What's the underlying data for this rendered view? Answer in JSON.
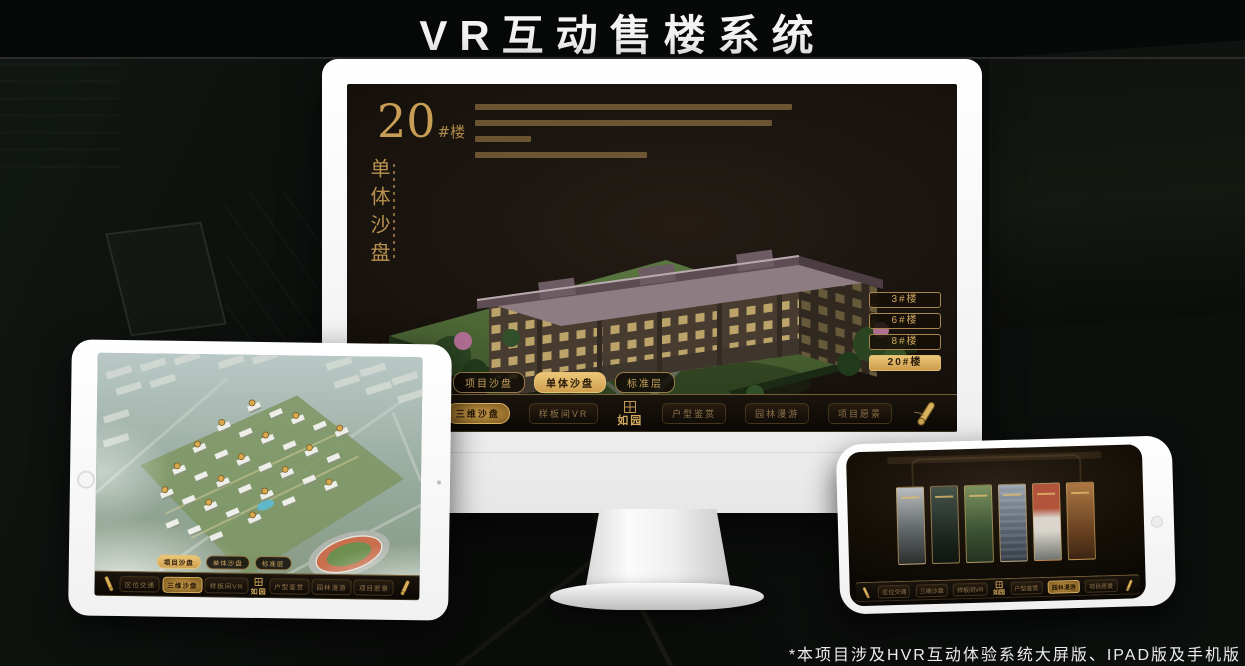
{
  "title": "VR互动售楼系统",
  "footnote": "*本项目涉及HVR互动体验系统大屏版、IPAD版及手机版",
  "brand": {
    "name": "如园"
  },
  "colors": {
    "gold": "#c9a35f",
    "gold_active": "#e0b96a",
    "screen_bg": "#171210"
  },
  "tabs": [
    "项目沙盘",
    "单体沙盘",
    "标准层"
  ],
  "nav_items": [
    "区位交通",
    "三维沙盘",
    "样板间VR",
    "户型鉴赏",
    "园林漫游",
    "项目愿景"
  ],
  "monitor": {
    "heading": {
      "number": "20",
      "suffix": "#楼",
      "vertical": "单体沙盘"
    },
    "floor_buttons": [
      {
        "label": "3#楼"
      },
      {
        "label": "6#楼"
      },
      {
        "label": "8#楼"
      },
      {
        "label": "20#楼"
      }
    ]
  }
}
